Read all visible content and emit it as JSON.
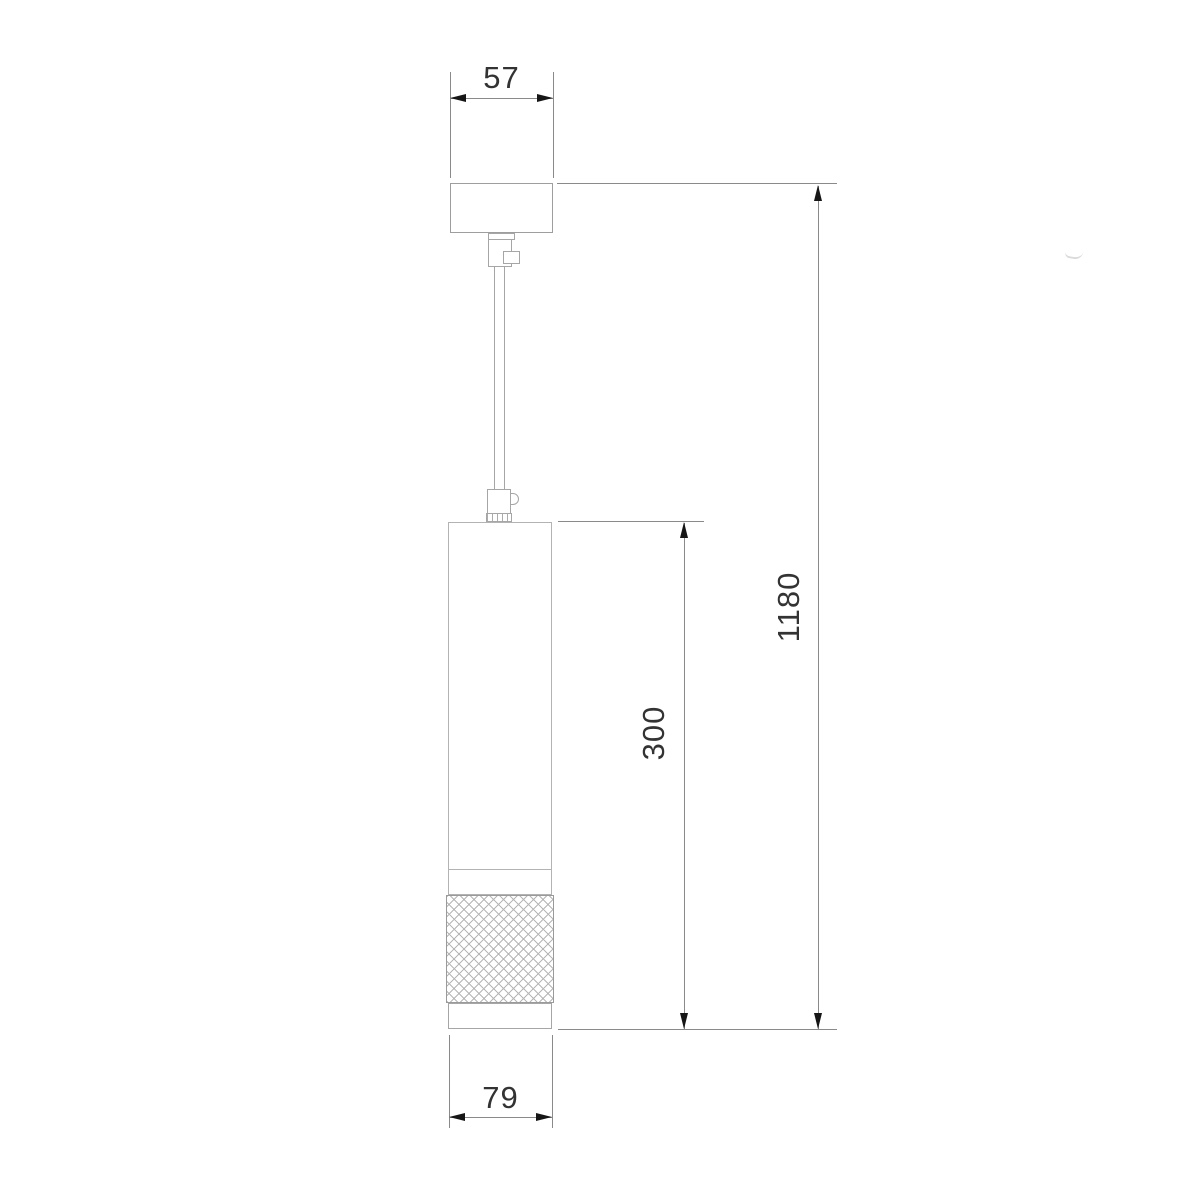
{
  "dimensions": {
    "canopy_width": "57",
    "overall_height": "1180",
    "body_height": "300",
    "body_diameter": "79"
  },
  "colors": {
    "background": "#ffffff",
    "object_line": "#a6a6a6",
    "dimension_line": "#8a8a8a",
    "arrow": "#161616",
    "label_text": "#333333"
  }
}
